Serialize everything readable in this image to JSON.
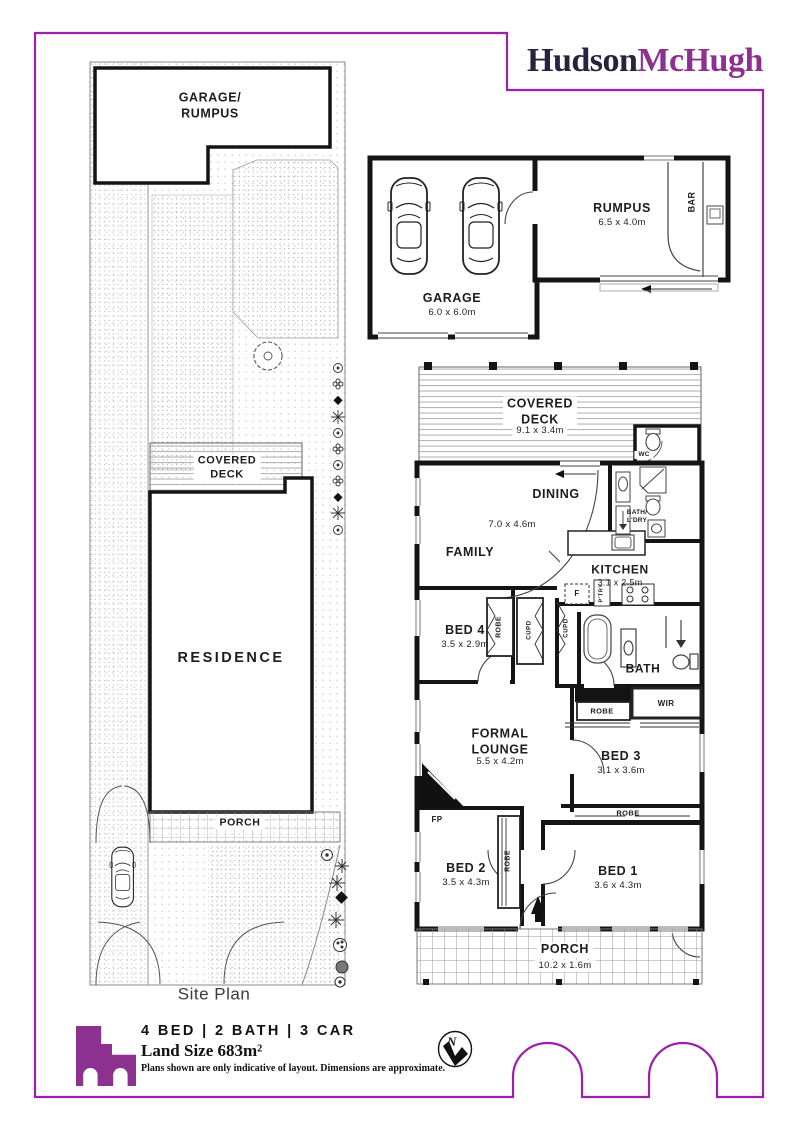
{
  "brand": {
    "hudson": "Hudson",
    "mchugh": "McHugh"
  },
  "site_plan": {
    "garage_rumpus": "GARAGE/\nRUMPUS",
    "covered_deck": "COVERED\nDECK",
    "residence": "RESIDENCE",
    "porch": "PORCH",
    "caption": "Site Plan"
  },
  "floor_plan": {
    "garage": {
      "name": "GARAGE",
      "dims": "6.0 x 6.0m"
    },
    "rumpus": {
      "name": "RUMPUS",
      "dims": "6.5 x 4.0m"
    },
    "bar": "BAR",
    "covered_deck": {
      "name": "COVERED\nDECK",
      "dims": "9.1 x 3.4m"
    },
    "wc": "WC",
    "dining": "DINING",
    "living_dims": "7.0 x 4.6m",
    "family": "FAMILY",
    "kitchen": {
      "name": "KITCHEN",
      "dims": "3.1 x 2.5m"
    },
    "bath_ldry": "BATH/\nL'DRY",
    "bed4": {
      "name": "BED 4",
      "dims": "3.5 x 2.9m"
    },
    "bath": "BATH",
    "formal_lounge": {
      "name": "FORMAL\nLOUNGE",
      "dims": "5.5 x 4.2m"
    },
    "bed3": {
      "name": "BED 3",
      "dims": "3.1 x 3.6m"
    },
    "bed2": {
      "name": "BED 2",
      "dims": "3.5 x 4.3m"
    },
    "bed1": {
      "name": "BED 1",
      "dims": "3.6 x 4.3m"
    },
    "porch": {
      "name": "PORCH",
      "dims": "10.2 x 1.6m"
    },
    "robe": "ROBE",
    "wir": "WIR",
    "cupd": "CUPD",
    "fp": "FP",
    "fridge": "F",
    "pantry": "P'TRY"
  },
  "footer": {
    "features": "4 BED | 2 BATH | 3 CAR",
    "land_size": "Land Size 683m²",
    "disclaimer": "Plans shown are only indicative of layout. Dimensions are approximate.",
    "compass_north": "N"
  },
  "colors": {
    "accent": "#9c1fae",
    "logo_dark": "#29223f",
    "logo_purple": "#8d3190",
    "wall": "#161616"
  }
}
